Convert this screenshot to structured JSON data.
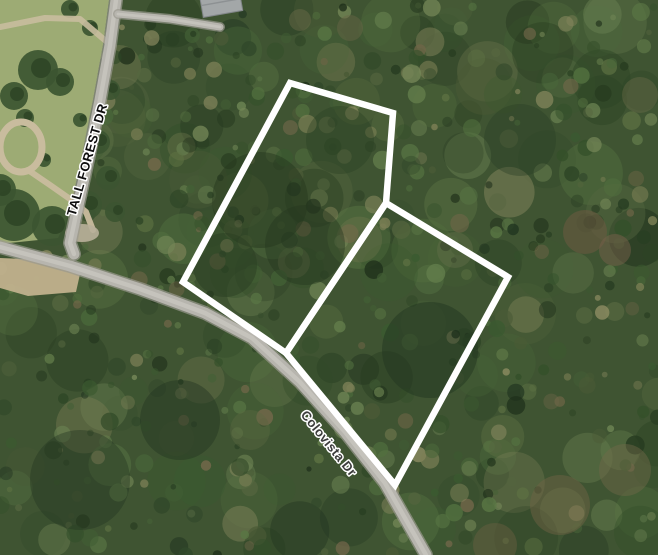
{
  "map": {
    "type": "satellite-aerial-imagery",
    "street_labels": [
      {
        "id": "tall-forest-dr",
        "text": "TALL FOREST DR",
        "color": "#0e0e0e",
        "halo": "#ffffff",
        "x": 88,
        "y": 160,
        "rotation": -74,
        "font_size": 13,
        "letter_spacing": 0.4
      },
      {
        "id": "colovista-dr",
        "text": "Colovista Dr",
        "color": "#3d3d3d",
        "halo": "#ffffff",
        "x": 328,
        "y": 444,
        "rotation": 51,
        "font_size": 13,
        "letter_spacing": 0.3
      }
    ],
    "parcels": [
      {
        "id": "parcel-outline-1",
        "outline_color": "#ffffff",
        "stroke_width": 6.5,
        "points": [
          [
            290,
            83
          ],
          [
            393,
            113
          ],
          [
            386,
            203
          ],
          [
            286,
            353
          ],
          [
            183,
            282
          ]
        ]
      },
      {
        "id": "parcel-outline-2",
        "outline_color": "#ffffff",
        "stroke_width": 6.5,
        "points": [
          [
            386,
            203
          ],
          [
            508,
            277
          ],
          [
            395,
            485
          ],
          [
            286,
            353
          ]
        ]
      }
    ],
    "roads": [
      {
        "id": "colovista-dr-road",
        "points": [
          [
            0,
            247
          ],
          [
            70,
            266
          ],
          [
            140,
            289
          ],
          [
            205,
            313
          ],
          [
            252,
            338
          ],
          [
            300,
            382
          ],
          [
            345,
            432
          ],
          [
            385,
            483
          ],
          [
            426,
            555
          ]
        ],
        "width": 11
      },
      {
        "id": "tall-forest-dr-road",
        "points": [
          [
            116,
            0
          ],
          [
            110,
            45
          ],
          [
            100,
            100
          ],
          [
            88,
            160
          ],
          [
            76,
            215
          ],
          [
            70,
            243
          ],
          [
            74,
            254
          ]
        ],
        "width": 11
      },
      {
        "id": "driveway",
        "points": [
          [
            118,
            14
          ],
          [
            170,
            19
          ],
          [
            220,
            27
          ]
        ],
        "width": 7
      }
    ],
    "palette": {
      "canopy_base": "#3f5432",
      "grass": "#9dab74",
      "dirt": "#c9bc9e",
      "road_fill": "#b7b5ae",
      "road_edge": "#9a988f",
      "road_center": "#c8c6be",
      "parcel_outline": "#ffffff"
    }
  }
}
